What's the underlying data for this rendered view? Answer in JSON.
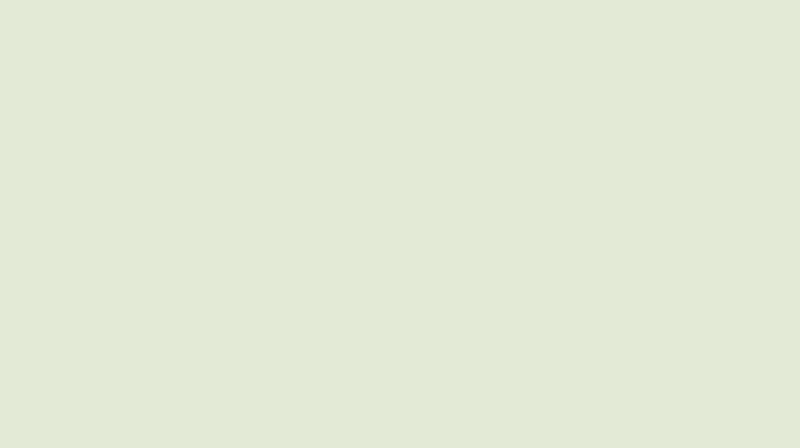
{
  "scene": {
    "type": "aerial-architectural-rendering",
    "subject": "industrial park master plan, bird's-eye perspective rendering",
    "description": "Aerial rendering of an industrial park: grids of white-roofed warehouses split by a tree-lined boulevard with a white entrance gate and roundabout, slate-roofed residential blocks along a diagonal road with a yellow centerline, a utility yard of round blue tanks and teal sheds, all surrounded by pale striped farmland fading into white haze at the top right",
    "palette": {
      "parkBase": "#9aad84",
      "fieldBaseBL": "#e3ead3",
      "fieldBaseBR": "#b3c89c",
      "fieldBaseTR": "#d7e3c6",
      "fieldPaleLeft": "#dee7cd",
      "bufferGrass": "#a3bd8e",
      "bandGreenNE": "#b7cc9f",
      "roadGray": "#8d9086",
      "roadMinor": "#a3a698",
      "sidewalkTan": "#c6b89c",
      "laneYellow": "#d8c14e",
      "laneWhite": "#eceee6",
      "medianGreen": "#4e7a44",
      "groundPink": "#c2a392",
      "lawnGreen": "#c5d7b2",
      "plazaTan": "#cabda1",
      "roofTopA": "#edf1f5",
      "roofMidA": "#dbe2e9",
      "roofBotA": "#c4ced8",
      "roofTopB": "#e3e9ee",
      "roofMidB": "#d0d8e1",
      "roofBotB": "#b9c5d1",
      "roofTopS": "#e9edf1",
      "roofBotS": "#ccd6df",
      "roofSeam": "#7e8a96",
      "roofRidge": "#f7f9fb",
      "roofShadow": "#5d6873",
      "laneGray": "#b2b6ab",
      "bushStrip": "#79a45f",
      "bushDark": "#2f5133",
      "bushBright": "#67994d",
      "treeDark": "#2a452e",
      "treeMid": "#47713f",
      "treeBright": "#6da24f",
      "resWall": "#9fb0ba",
      "resRoofLit": "#51626d",
      "resRoofDark": "#2b353d",
      "tealRoof": "#33595e",
      "tealRidge": "#6e9496",
      "darkGreenRoof": "#2e4b41",
      "waterGroundTan": "#c9bda0",
      "tankFill": "#4486b8",
      "tankRim": "#2d648e",
      "tankHi": "#77abd1",
      "smallRoofBlue": "#4d7fa6",
      "gateWhite": "#f3f4f1",
      "gateTrim": "#c9cdc6",
      "roundabout": "#989c90",
      "vehicleRed": "#c8392b",
      "carDark": "#22272d",
      "carWhite": "#e9ebe8",
      "carBlue": "#3f6fc0",
      "hazeWhite": "#f7f9f4",
      "letterbox": "#1e241d"
    },
    "fields": {
      "bottom_left": {
        "angle": 16,
        "bands": [
          [
            "#eef2e0",
            0.55,
            26
          ],
          [
            "#d3dfbd",
            0.6,
            24
          ],
          [
            "#dee8cb",
            0.45,
            30
          ],
          [
            "#c8d7b0",
            0.55,
            22
          ]
        ]
      },
      "bottom_right": {
        "angle": -26.6,
        "bands": [
          [
            "#c3d4ab",
            0.7,
            28
          ],
          [
            "#a7bf90",
            0.7,
            26
          ],
          [
            "#bccfa4",
            0.6,
            30
          ],
          [
            "#9cb687",
            0.7,
            24
          ]
        ]
      },
      "top_right": {
        "angle": -14,
        "bands": [
          [
            "#ffffff",
            0.14,
            34
          ],
          [
            "#b4c89c",
            0.22,
            30
          ],
          [
            "#ffffff",
            0.1,
            26
          ],
          [
            "#c2d4aa",
            0.2,
            32
          ]
        ]
      }
    },
    "areas": [
      {
        "name": "warehouse-cluster-northwest",
        "label": "northwest warehouse block",
        "detail": "about 5 rows x 4 columns of long white-roofed factory halls separated by hedge strips"
      },
      {
        "name": "warehouse-cluster-southeast",
        "label": "southeast warehouse block",
        "detail": "large white-roofed halls plus rows of smaller workshop units toward the northeast corner"
      },
      {
        "name": "water-treatment-area",
        "label": "utility yard",
        "detail": "round blue basins, two teal sheds, one dark-green shed, small blue-roofed units on tan ground"
      },
      {
        "name": "residential-strip",
        "label": "residential blocks",
        "detail": "about 20 slate-roofed mid-rise blocks flanking the diagonal road"
      },
      {
        "name": "entrance-gate",
        "label": "main entrance",
        "detail": "white gate building, tan plaza and gray roundabout marking"
      },
      {
        "name": "main-boulevard",
        "label": "tree-lined boulevard",
        "detail": "crosses the park from lower left to upper right, forks near the haze"
      },
      {
        "name": "residential-road",
        "label": "diagonal road",
        "detail": "yellow dashed centerline, runs top-left to bottom-center"
      },
      {
        "name": "farmland",
        "label": "striped farm fields",
        "detail": "pale fields on three sides fading into white haze at top right"
      }
    ],
    "vehicles": {
      "red_buses": 5,
      "cars": "about 25 small dark, white and blue cars"
    }
  }
}
